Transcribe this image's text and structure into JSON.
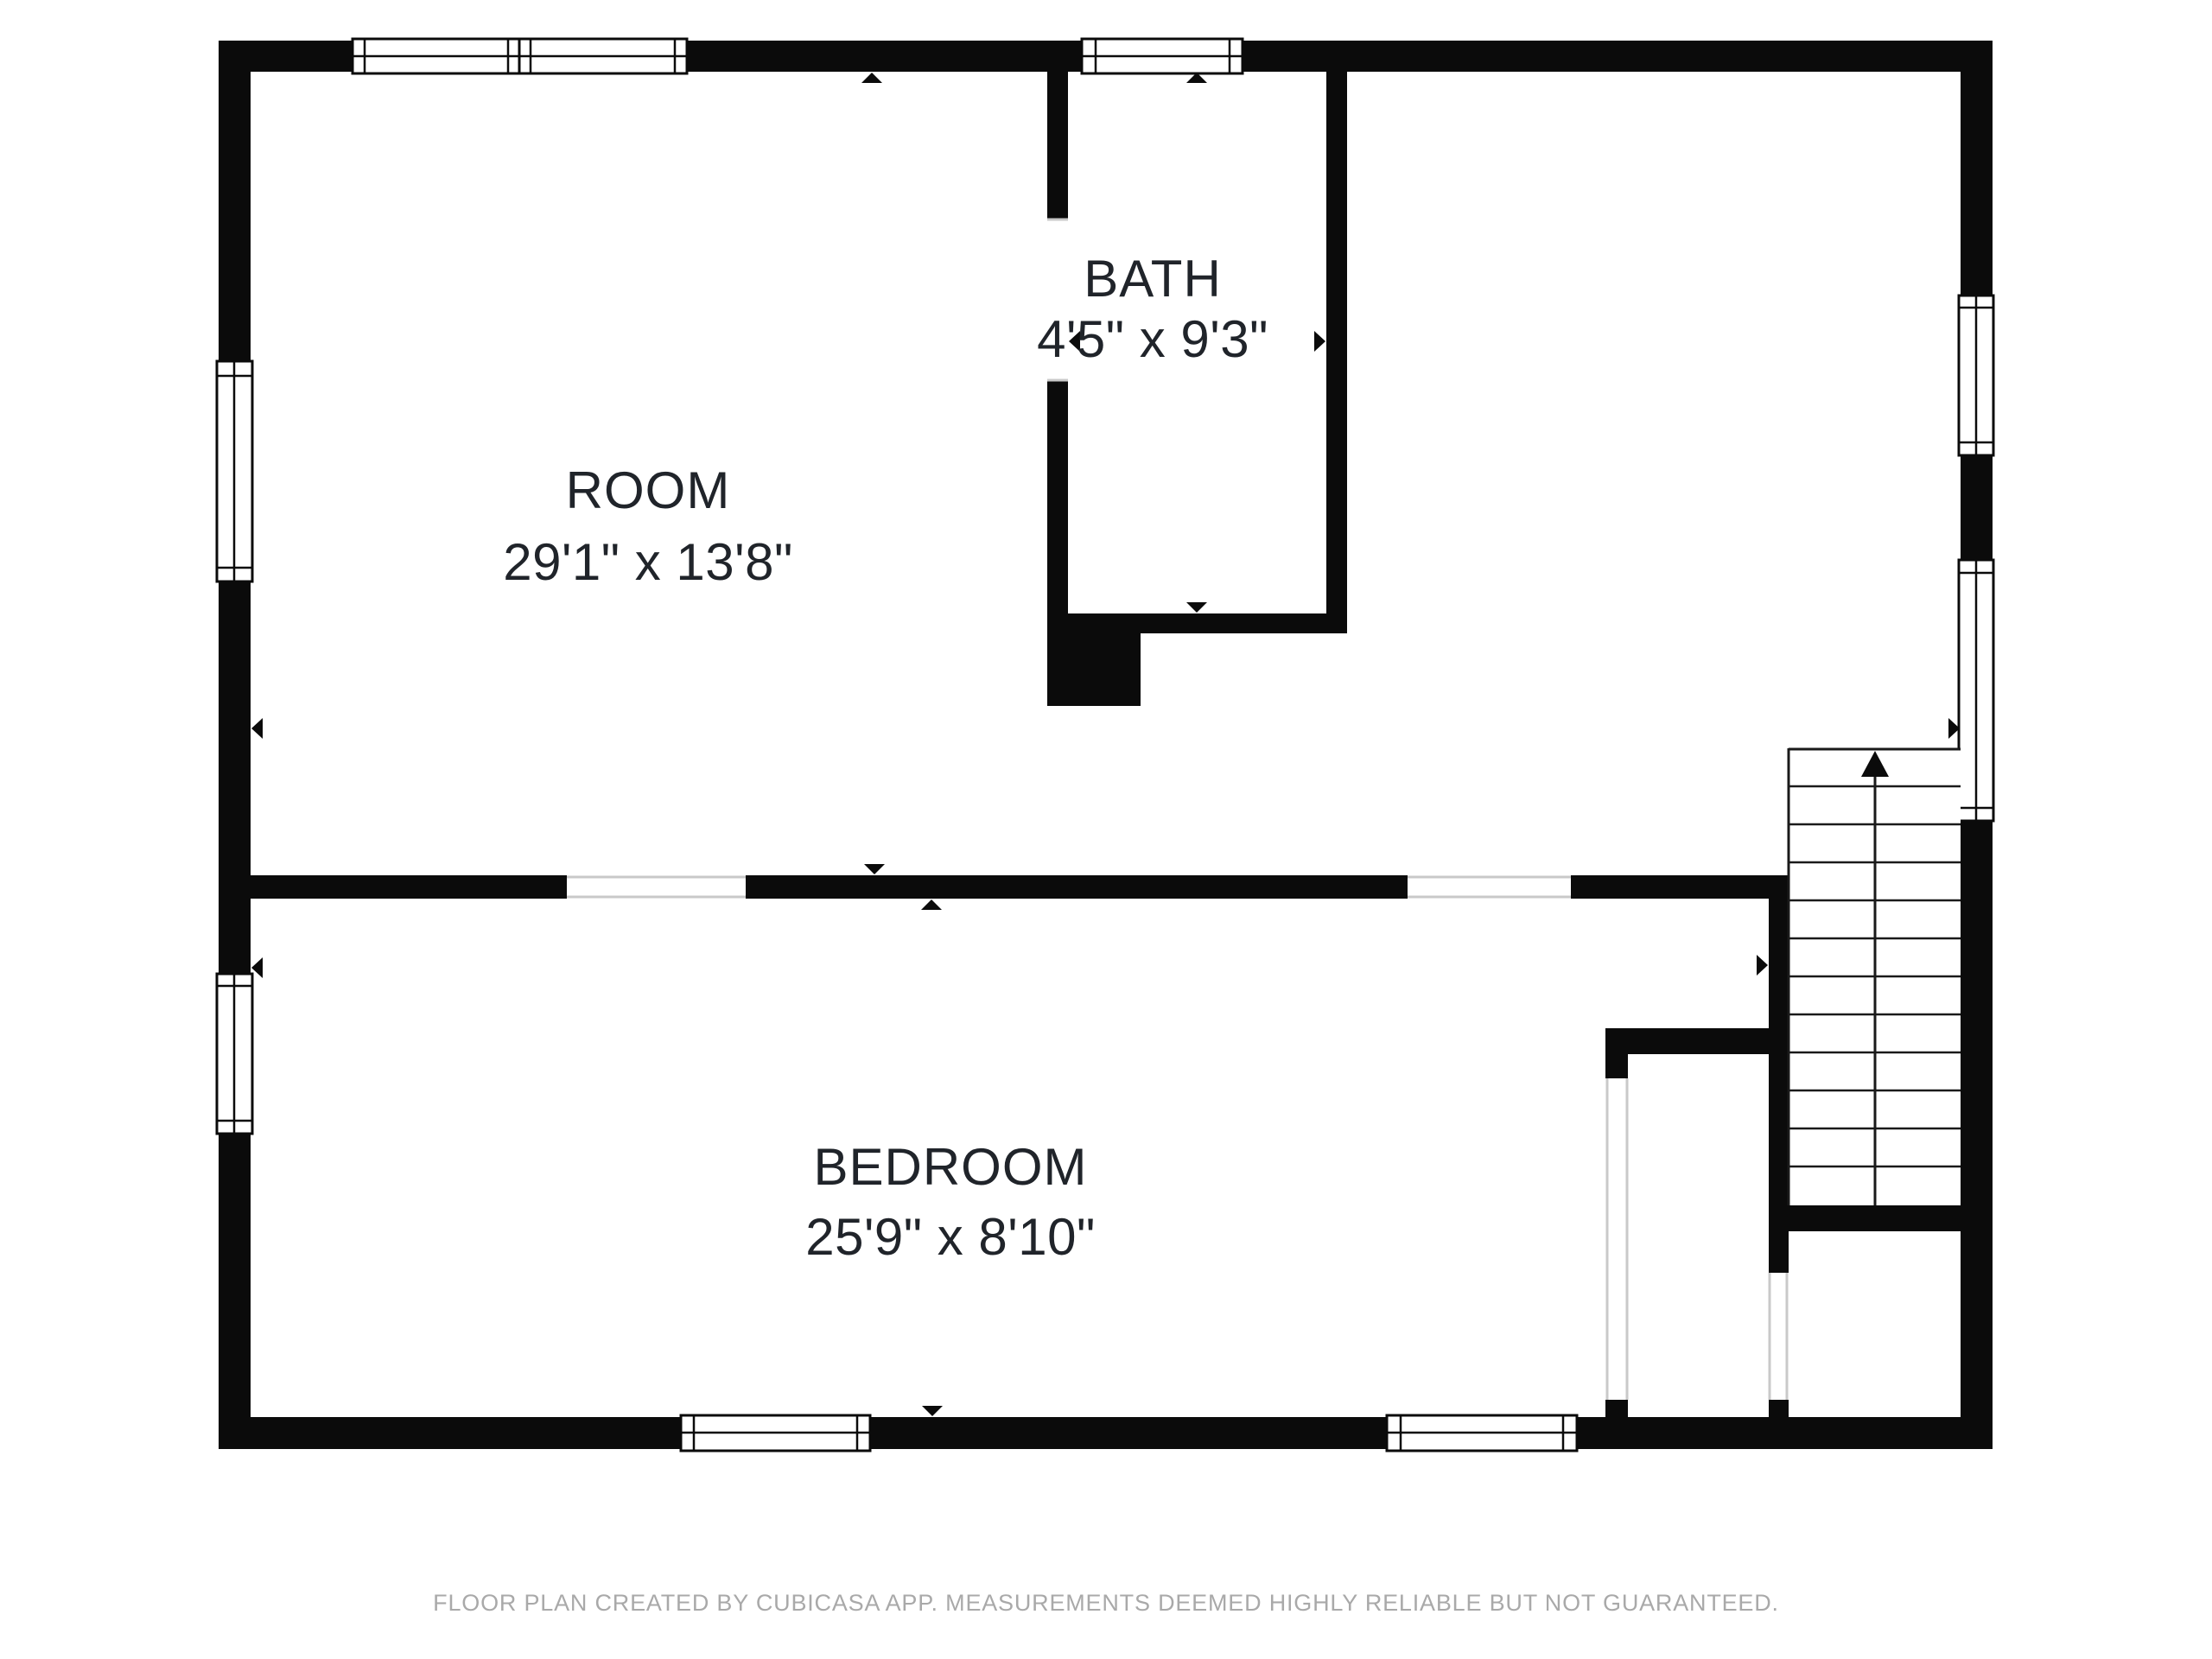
{
  "plan": {
    "rooms": [
      {
        "name": "ROOM",
        "dimensions": "29'1\" x 13'8\""
      },
      {
        "name": "BATH",
        "dimensions": "4'5\" x 9'3\""
      },
      {
        "name": "BEDROOM",
        "dimensions": "25'9\" x 8'10\""
      }
    ],
    "stairs": {
      "symbol": "up-arrow",
      "flights": 2,
      "treads_per_flight": 12
    }
  },
  "footer": {
    "disclaimer": "FLOOR PLAN CREATED BY CUBICASA APP. MEASUREMENTS DEEMED HIGHLY RELIABLE BUT NOT GUARANTEED."
  },
  "colors": {
    "wall": "#0b0b0b",
    "room_text": "#20242a",
    "footer_text": "#a9a9a9",
    "door_line": "#c9c9c9",
    "stair_line": "#1a1a1a",
    "background": "#ffffff"
  }
}
